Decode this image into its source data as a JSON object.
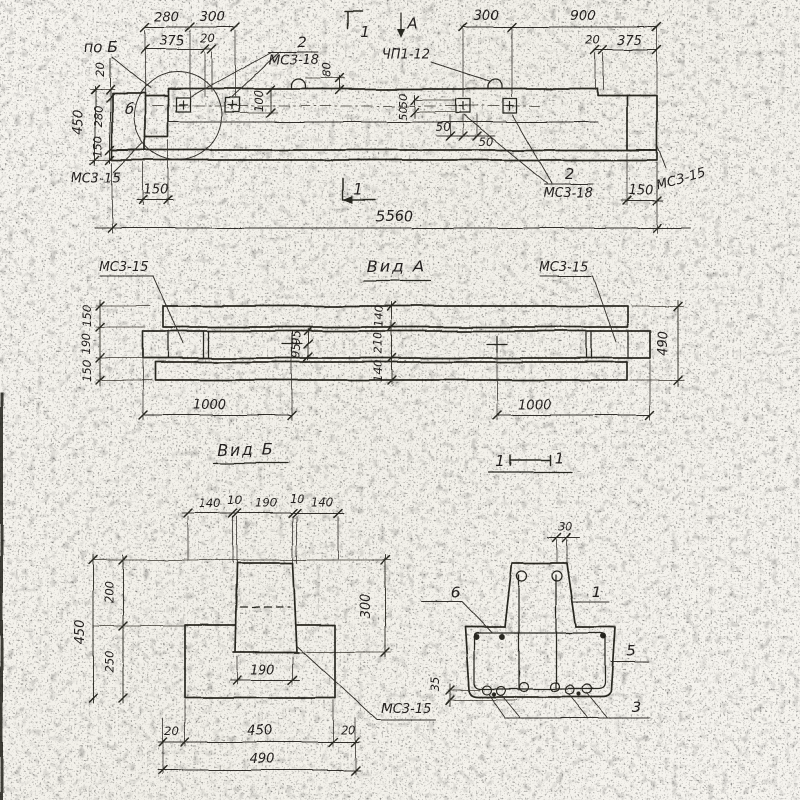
{
  "meta": {
    "kind": "scanned structural drawing",
    "language": "ru"
  },
  "colors": {
    "paper": "#f5f3ee",
    "ink": "#2b2924"
  },
  "top_view": {
    "section_flag_top": "1",
    "view_arrow_label": "А",
    "dim_280": "280",
    "dim_300_left": "300",
    "dim_375_left": "375",
    "dim_20_top_left": "20",
    "dim_300_right": "300",
    "dim_900": "900",
    "dim_20_top_right": "20",
    "dim_375_right": "375",
    "label_po_b": "по Б",
    "callout_left_num": "2",
    "callout_left_name": "МС3-18",
    "label_loop": "ЧП1-12",
    "dim_80": "80",
    "dim_100": "100",
    "dim_50_v_a": "50",
    "dim_50_v_b": "50",
    "dim_50_h_a": "50",
    "dim_50_h_b": "50",
    "dim_450_side": "450",
    "dim_20_side": "20",
    "dim_280_side": "280",
    "dim_150_side": "150",
    "label_b": "б",
    "label_ms315_left": "МС3-15",
    "dim_150_bl": "150",
    "dim_5560": "5560",
    "section_flag_bottom": "1",
    "callout_right_num": "2",
    "callout_right_name": "МС3-18",
    "dim_150_br": "150",
    "label_ms315_right": "МС3-15"
  },
  "view_a": {
    "title": "Вид А",
    "label_left": "МС3-15",
    "label_right": "МС3-15",
    "dim_150_t": "150",
    "dim_190": "190",
    "dim_150_b": "150",
    "dim_95_a": "95",
    "dim_95_b": "95",
    "dim_140_t": "140",
    "dim_210": "210",
    "dim_140_b": "140",
    "dim_490": "490",
    "dim_1000_l": "1000",
    "dim_1000_r": "1000"
  },
  "view_b": {
    "title": "Вид Б",
    "dim_140_l": "140",
    "dim_10_l": "10",
    "dim_190_top": "190",
    "dim_10_r": "10",
    "dim_140_r": "140",
    "dim_200": "200",
    "dim_250": "250",
    "dim_450_side": "450",
    "dim_300": "300",
    "dim_190_bot": "190",
    "dim_20_l": "20",
    "dim_450_bot": "450",
    "dim_20_r": "20",
    "dim_490": "490",
    "label_ms315": "МС3-15"
  },
  "section": {
    "title_l": "1",
    "title_r": "1",
    "dim_30": "30",
    "dim_35": "35",
    "label_6": "6",
    "label_1": "1",
    "label_5": "5",
    "label_3": "3"
  }
}
